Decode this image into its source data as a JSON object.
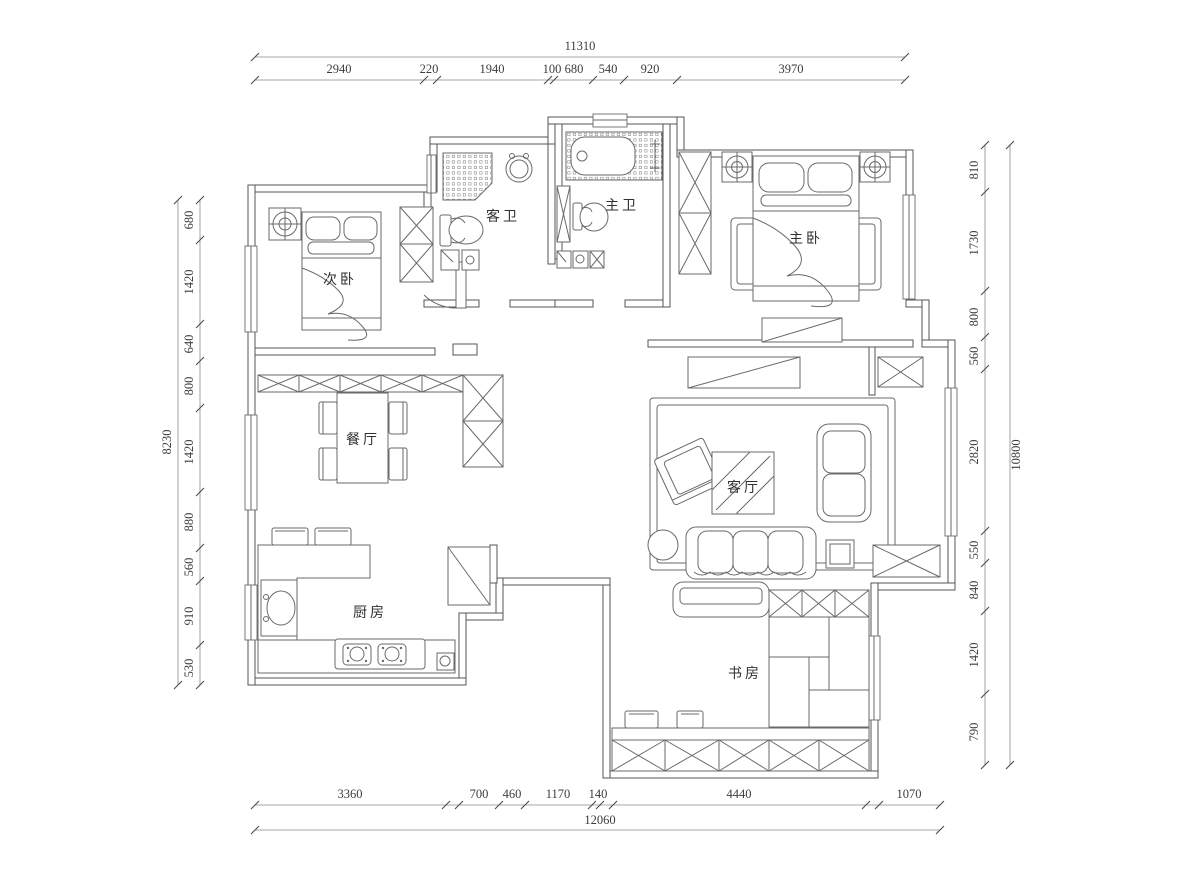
{
  "drawing": {
    "type": "apartment-floor-plan",
    "units": "mm",
    "line_color": "#565656",
    "background": "#ffffff"
  },
  "rooms": {
    "bedroom2": "次卧",
    "guest_bath": "客卫",
    "master_bath": "主卫",
    "master_bedroom": "主卧",
    "dining": "餐厅",
    "living": "客厅",
    "kitchen": "厨房",
    "study": "书房"
  },
  "dims": {
    "top": {
      "total": "11310",
      "values": [
        "2940",
        "220",
        "1940",
        "100",
        "680",
        "540",
        "920",
        "3970"
      ]
    },
    "bottom": {
      "total": "12060",
      "values": [
        "3360",
        "700",
        "460",
        "1170",
        "140",
        "4440",
        "1070"
      ]
    },
    "left": {
      "total": "8230",
      "values": [
        "680",
        "1420",
        "640",
        "800",
        "1420",
        "880",
        "560",
        "910",
        "530"
      ]
    },
    "right": {
      "total": "10800",
      "values": [
        "810",
        "1730",
        "800",
        "560",
        "2820",
        "550",
        "840",
        "1420",
        "790"
      ]
    }
  }
}
